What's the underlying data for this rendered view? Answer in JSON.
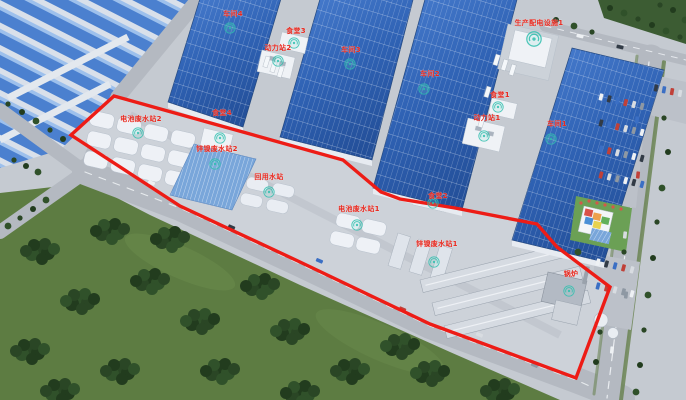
{
  "labels": {
    "workshop_4": "车间4",
    "canteen_3": "食堂3",
    "power_station_2": "动力站2",
    "workshop_3": "车间3",
    "production_power_facility_1": "生产配电设施1",
    "workshop_2": "车间2",
    "canteen_1": "食堂1",
    "power_station_1": "动力站1",
    "workshop_1": "车间1",
    "battery_wastewater_station_2": "电池废水站2",
    "canteen_4": "食堂4",
    "zinc_nickel_wastewater_station_2": "锌镍废水站2",
    "water_reuse_station": "回用水站",
    "battery_wastewater_station_1": "电池废水站1",
    "zinc_nickel_wastewater_station_1": "锌镍废水站1",
    "canteen_2": "食堂2",
    "boiler_house": "锅炉"
  },
  "colors": {
    "boundary_red": "#ed1c16",
    "label_red": "#e8281e",
    "solar_roof_blue": "#3567b8",
    "shed_blue": "#4b80cf",
    "forest_green": "#2a4625",
    "field_green": "#5d7c42",
    "road_gray": "#b4b9c1",
    "logo_teal": "#2fbfae"
  }
}
